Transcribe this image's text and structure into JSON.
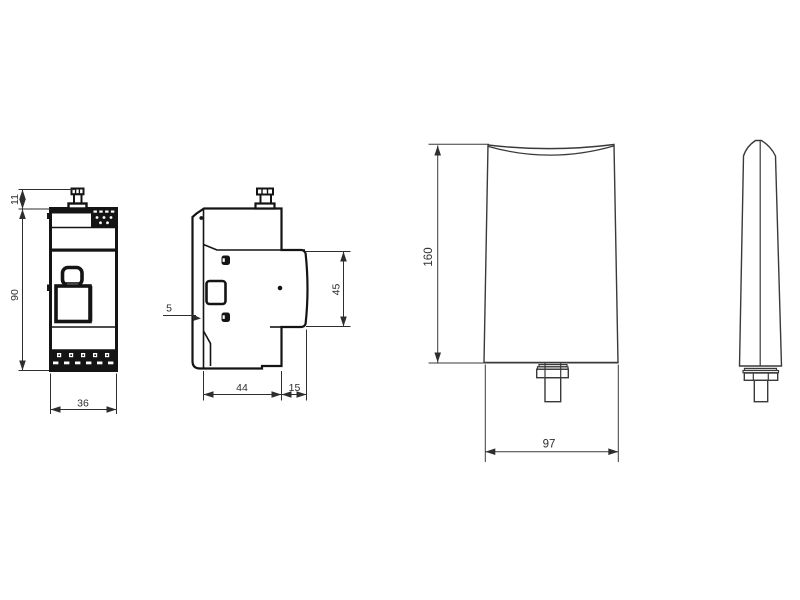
{
  "drawing": {
    "background_color": "#ffffff",
    "line_color": "#141414",
    "dimension_color": "#2e2e2e",
    "device_front": {
      "connector_height": "11",
      "body_height": "90",
      "body_width": "36"
    },
    "device_side": {
      "clip_offset": "5",
      "body_depth": "44",
      "cover_depth": "15",
      "cover_height": "45"
    },
    "antenna_front": {
      "height": "160",
      "width": "97"
    }
  }
}
